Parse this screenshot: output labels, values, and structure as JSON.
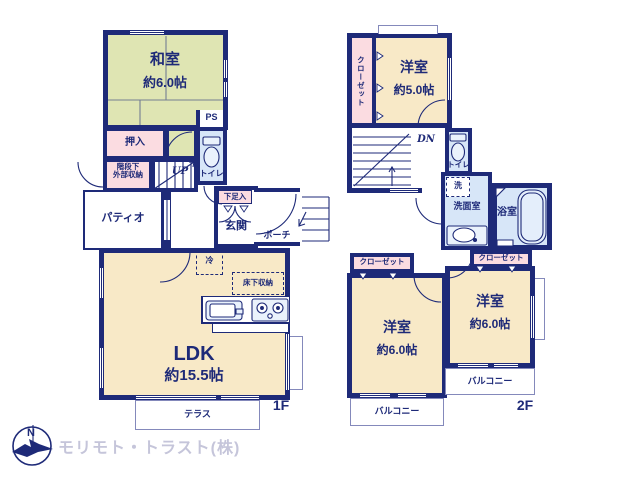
{
  "colors": {
    "wall": "#1e2a78",
    "text": "#1e2a78",
    "tatami": "#dfe5b3",
    "room": "#f8e9c7",
    "closet": "#fbdce1",
    "wet": "#d7e6f8",
    "fixture": "#eaf2fc",
    "thin": "#8489bb",
    "company": "#c5c5da"
  },
  "floor1": {
    "label": "1F",
    "washitsu": {
      "name": "和室",
      "size": "約6.0帖"
    },
    "oshiire": "押入",
    "ps": "PS",
    "toilet": "トイレ",
    "under_stairs": {
      "line1": "階段下",
      "line2": "外部収納"
    },
    "up": "UP",
    "patio": "パティオ",
    "shoe_box": "下足入",
    "genkan": "玄関",
    "porch": "ポーチ",
    "fridge": "冷",
    "underfloor": "床下収納",
    "ldk": {
      "name": "LDK",
      "size": "約15.5帖"
    },
    "terrace": "テラス"
  },
  "floor2": {
    "label": "2F",
    "closet_top": "クローゼット",
    "room_5": {
      "name": "洋室",
      "size": "約5.0帖"
    },
    "dn": "DN",
    "toilet": "トイレ",
    "washer": "洗",
    "washroom": "洗面室",
    "bath": "浴室",
    "closet_left": "クローゼット",
    "closet_right": "クローゼット",
    "room_6_left": {
      "name": "洋室",
      "size": "約6.0帖"
    },
    "room_6_right": {
      "name": "洋室",
      "size": "約6.0帖"
    },
    "balcony_left": "バルコニー",
    "balcony_right": "バルコニー"
  },
  "footer": {
    "compass": "N",
    "company": "モリモト・トラスト(株)"
  }
}
